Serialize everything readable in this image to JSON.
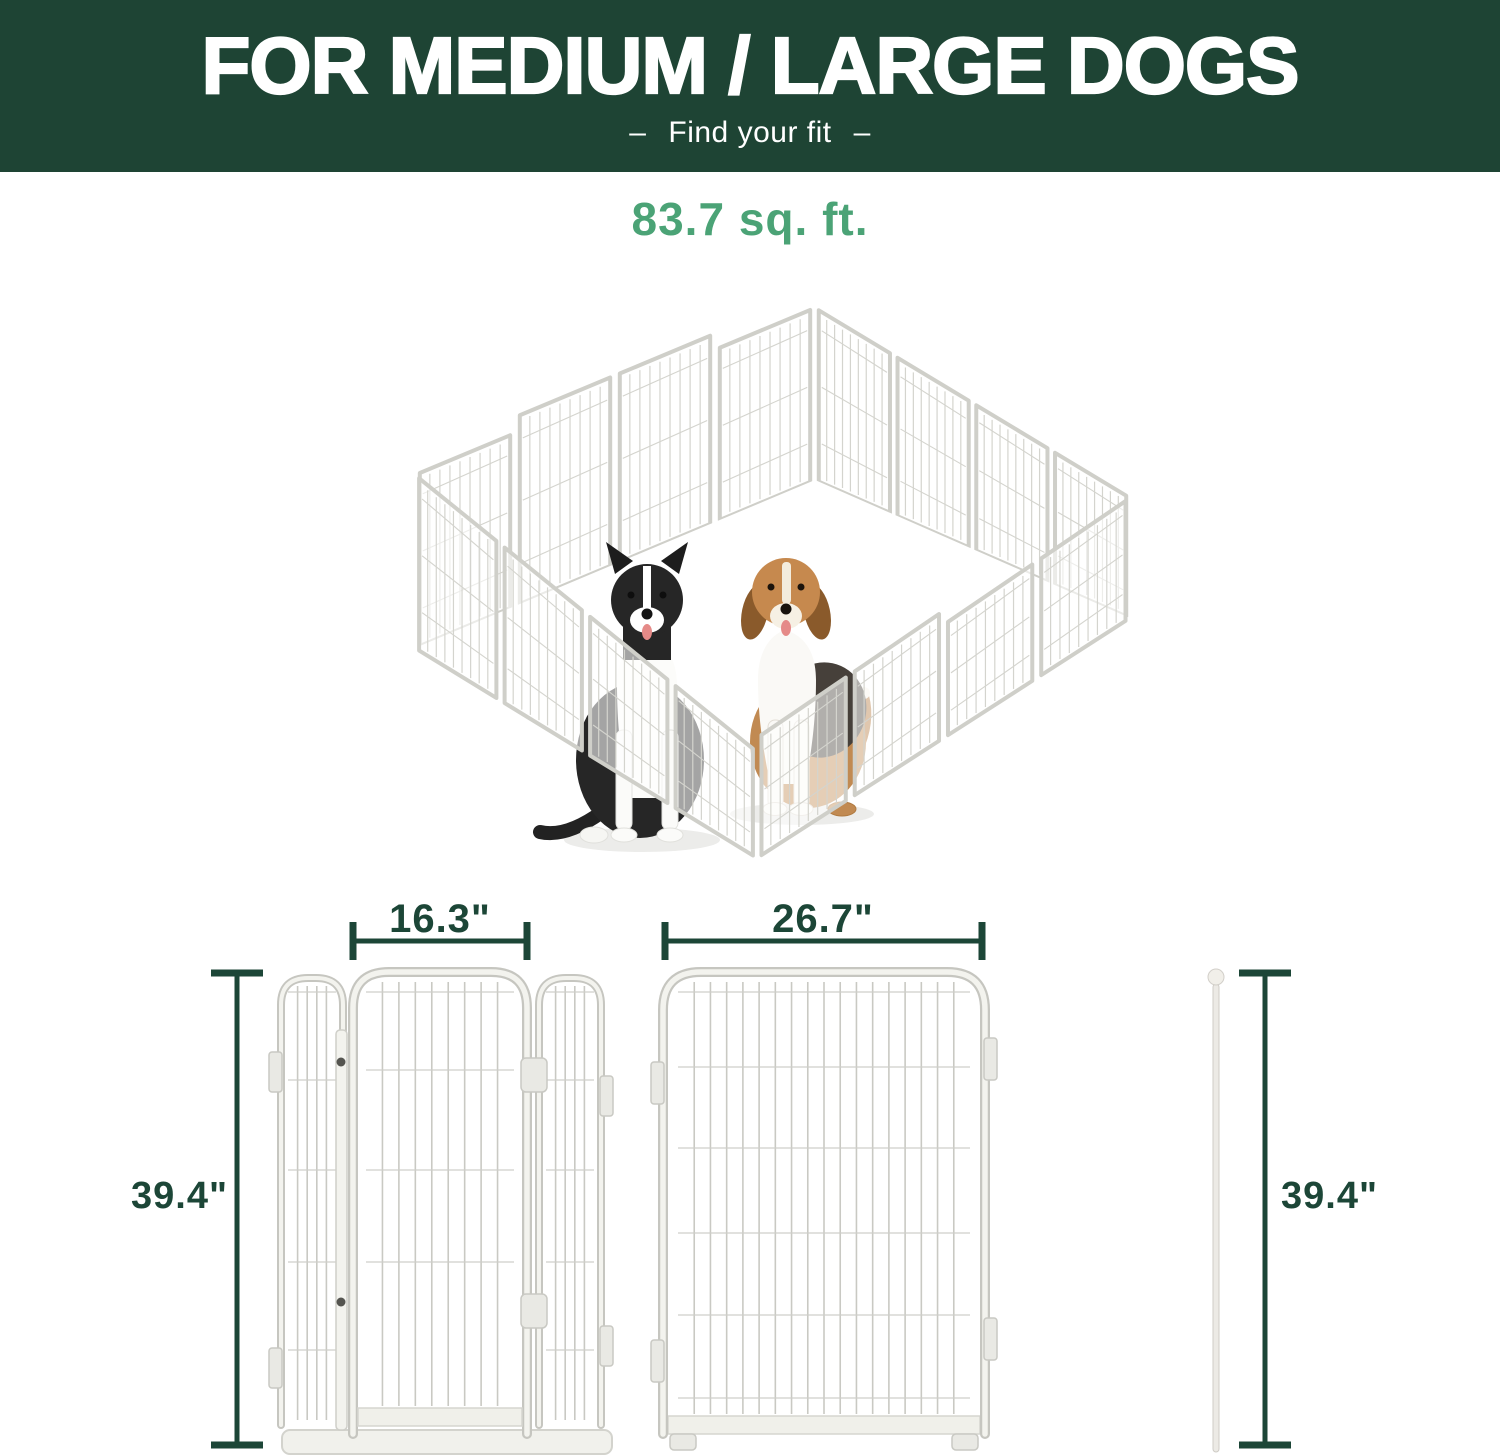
{
  "header": {
    "title": "FOR MEDIUM / LARGE DOGS",
    "dash_left": "–",
    "subtitle": "Find your fit",
    "dash_right": "–"
  },
  "area_label": "83.7 sq. ft.",
  "dimensions": {
    "gate_width": "16.3\"",
    "panel_width": "26.7\"",
    "height_left": "39.4\"",
    "height_right": "39.4\""
  },
  "figures": {
    "playpen": "playpen-isometric",
    "dogs": [
      "border-collie",
      "beagle"
    ],
    "parts": [
      "gate-panel-with-door",
      "wide-panel",
      "connector-rod"
    ]
  },
  "colors": {
    "header_bg": "#1e4434",
    "accent_green": "#4ba376",
    "dimension_green": "#1c4637",
    "panel_frame": "#c6c6c0"
  }
}
